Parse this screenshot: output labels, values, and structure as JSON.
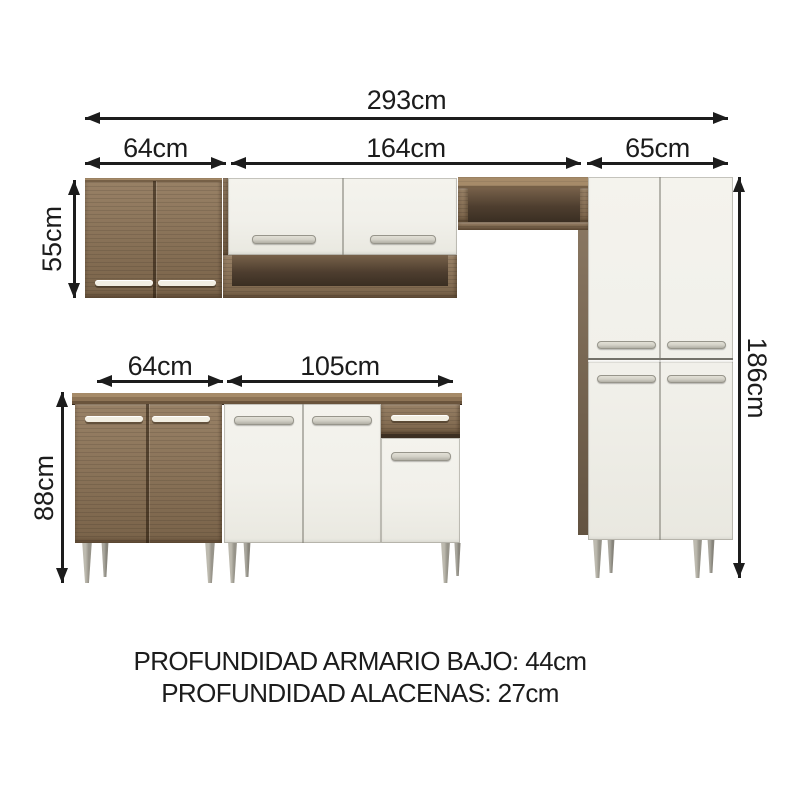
{
  "dims": {
    "total_width": "293cm",
    "upper_left_width": "64cm",
    "upper_mid_width": "164cm",
    "upper_right_width": "65cm",
    "wall_cabinet_height": "55cm",
    "base_cabinet_height": "88cm",
    "tall_cabinet_height": "186cm",
    "base_left_width": "64cm",
    "base_mid_width": "105cm"
  },
  "footer": {
    "depth_base": "PROFUNDIDAD ARMARIO BAJO: 44cm",
    "depth_wall": "PROFUNDIDAD ALACENAS: 27cm"
  },
  "colors": {
    "ink": "#1c1c1c",
    "wood": "#8d7355",
    "wood_light": "#a68b69",
    "wood_dark": "#6a543c",
    "wood_side": "#7e6a53",
    "interior_top": "#77614a",
    "interior_bottom": "#3a2e22",
    "panel_white": "#f1f0ea",
    "handle_cream": "#f2eee2",
    "handle_silver": "#d4d2c8",
    "leg": "#bdbaaf",
    "leg_shade": "#97948a"
  }
}
